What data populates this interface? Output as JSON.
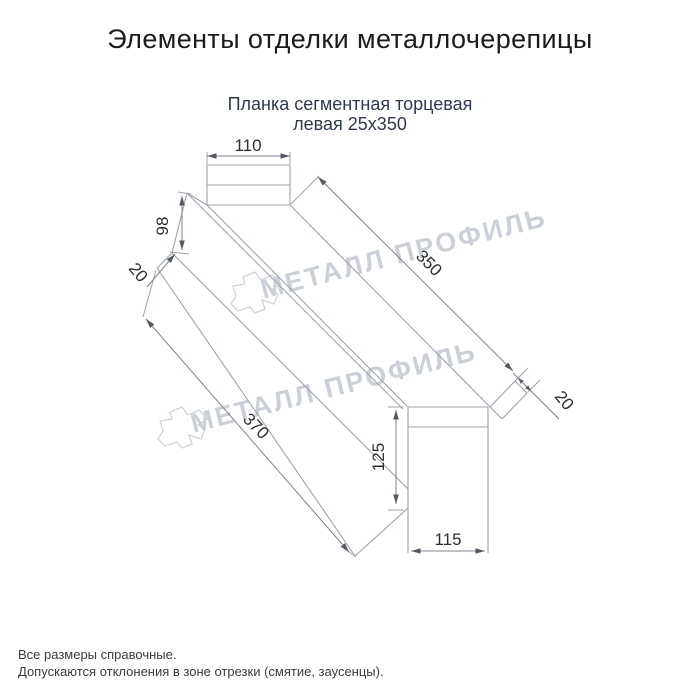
{
  "header": {
    "title": "Элементы отделки металлочерепицы"
  },
  "product": {
    "subtitle_line1": "Планка сегментная торцевая",
    "subtitle_line2": "левая 25х350"
  },
  "drawing": {
    "type": "technical-dimension-drawing",
    "dimensions": {
      "top_end_width": "110",
      "left_end_height": "98",
      "left_flange": "20",
      "length_top_edge": "350",
      "right_flange": "20",
      "length_bottom_edge": "370",
      "right_end_height": "125",
      "right_end_width": "115"
    }
  },
  "watermark": {
    "text": "МЕТАЛЛ ПРОФИЛЬ",
    "color": "#cbd0d8"
  },
  "footer": {
    "note1": "Все размеры справочные.",
    "note2": "Допускаются отклонения в зоне отрезки (смятие, заусенцы)."
  },
  "colors": {
    "background": "#ffffff",
    "drawing_lines": "#9ca3ad",
    "dimension_text": "#2d2d30",
    "subtitle": "#2e3950",
    "title": "#1a1b1d"
  }
}
